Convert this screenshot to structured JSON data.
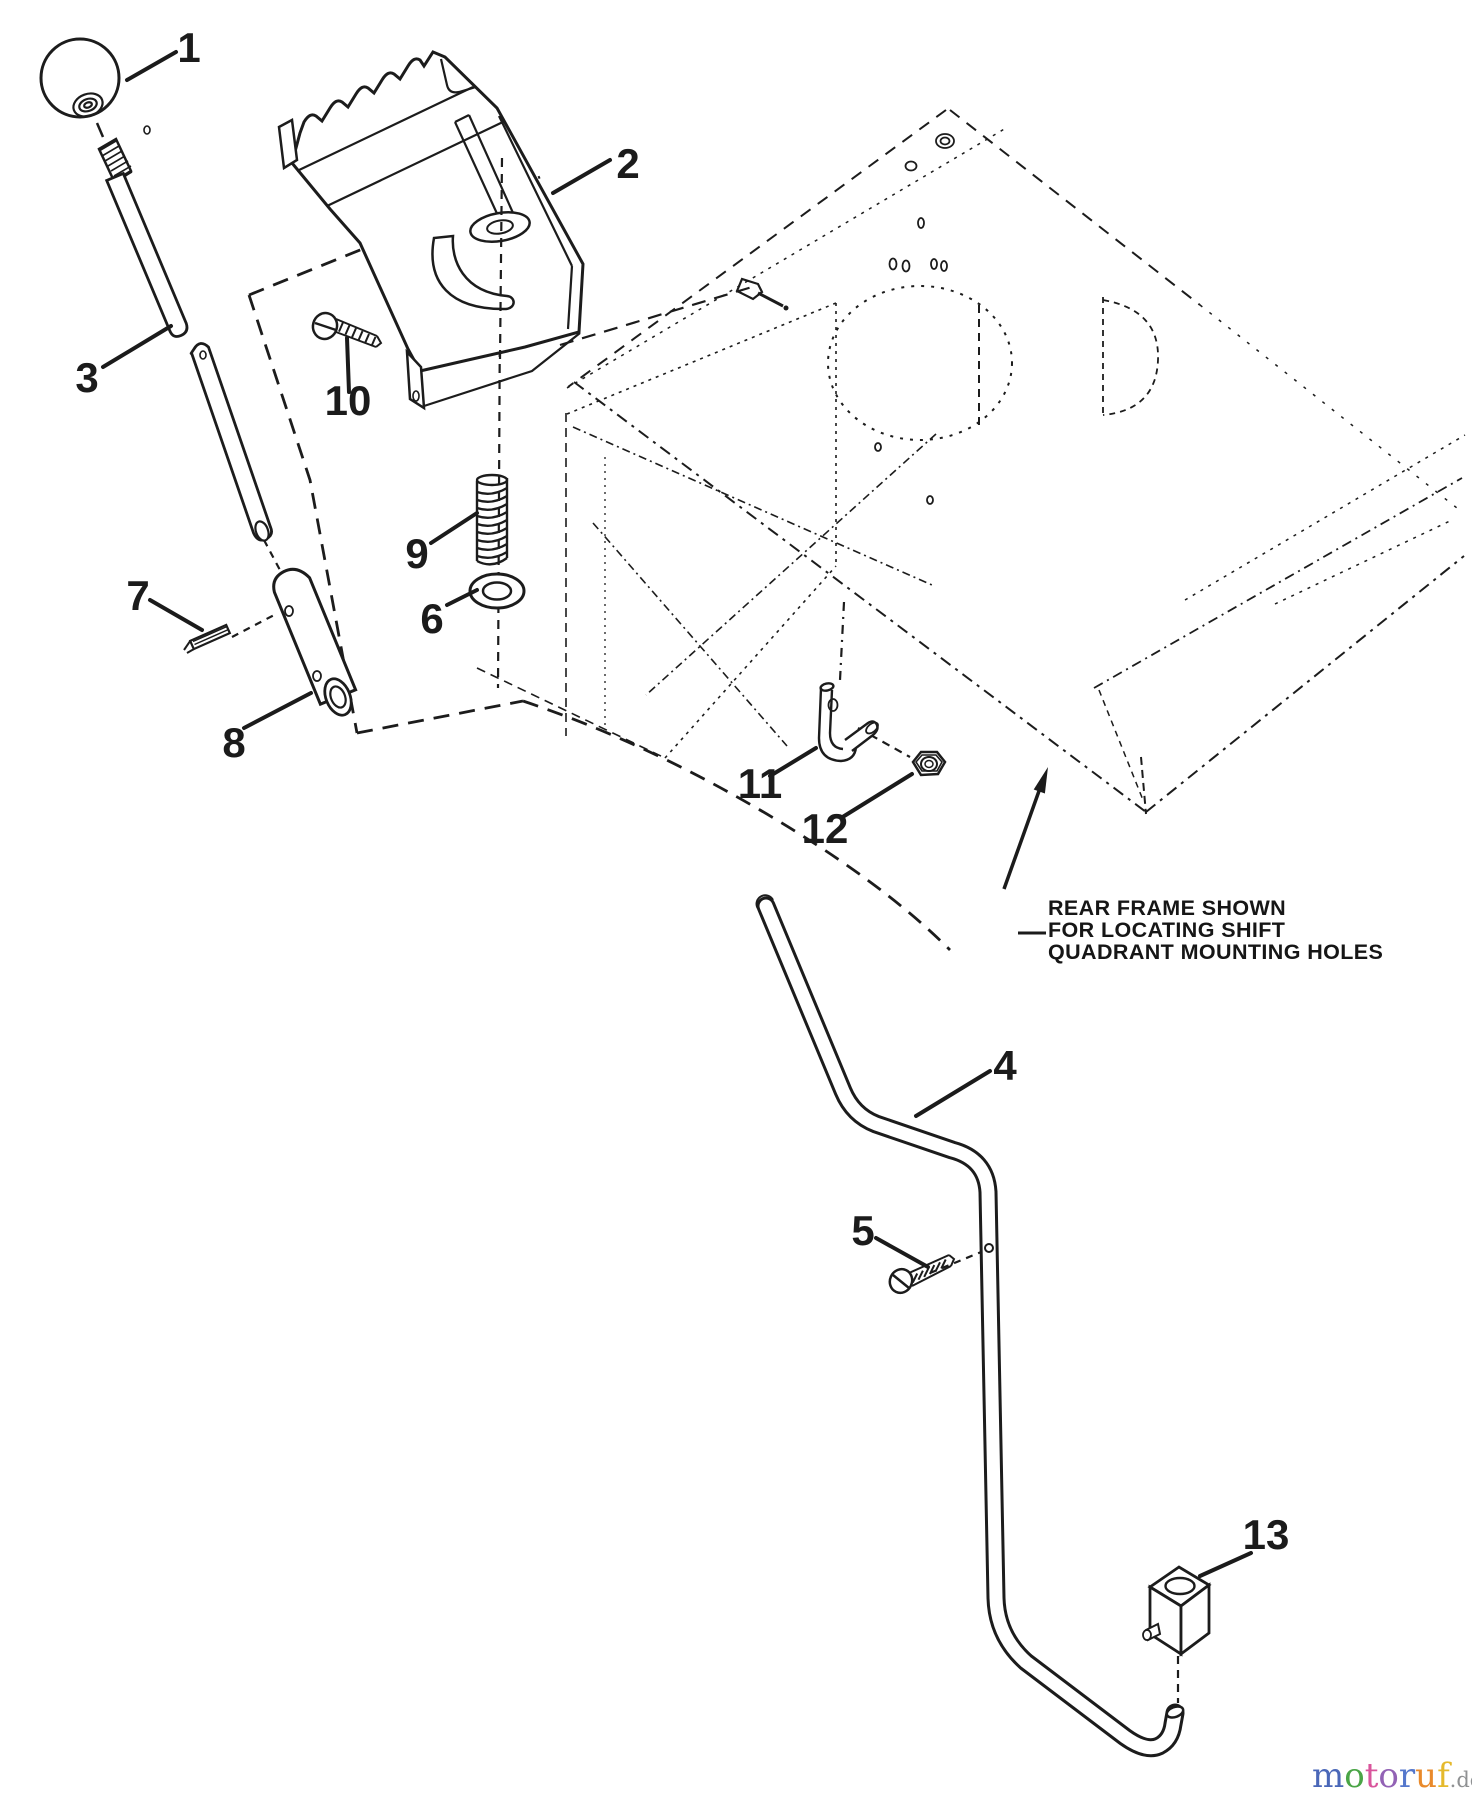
{
  "diagram": {
    "kind": "exploded-parts-diagram",
    "ink_color": "#1c1c1c",
    "background_color": "#ffffff",
    "callouts": [
      "1",
      "2",
      "3",
      "4",
      "5",
      "6",
      "7",
      "8",
      "9",
      "10",
      "11",
      "12",
      "13"
    ],
    "annotation": {
      "lines": [
        "REAR FRAME SHOWN",
        "FOR LOCATING SHIFT",
        "QUADRANT MOUNTING HOLES"
      ]
    }
  },
  "watermark": {
    "text": "motoruf.de",
    "letters": [
      {
        "char": "m",
        "color": "#4a67b8"
      },
      {
        "char": "o",
        "color": "#4aa546"
      },
      {
        "char": "t",
        "color": "#d9559c"
      },
      {
        "char": "o",
        "color": "#9262b5"
      },
      {
        "char": "r",
        "color": "#5577cc"
      },
      {
        "char": "u",
        "color": "#e98a2b"
      },
      {
        "char": "f",
        "color": "#e5b92c"
      }
    ],
    "suffix": {
      "char": ".de",
      "color": "#8f9193"
    }
  }
}
